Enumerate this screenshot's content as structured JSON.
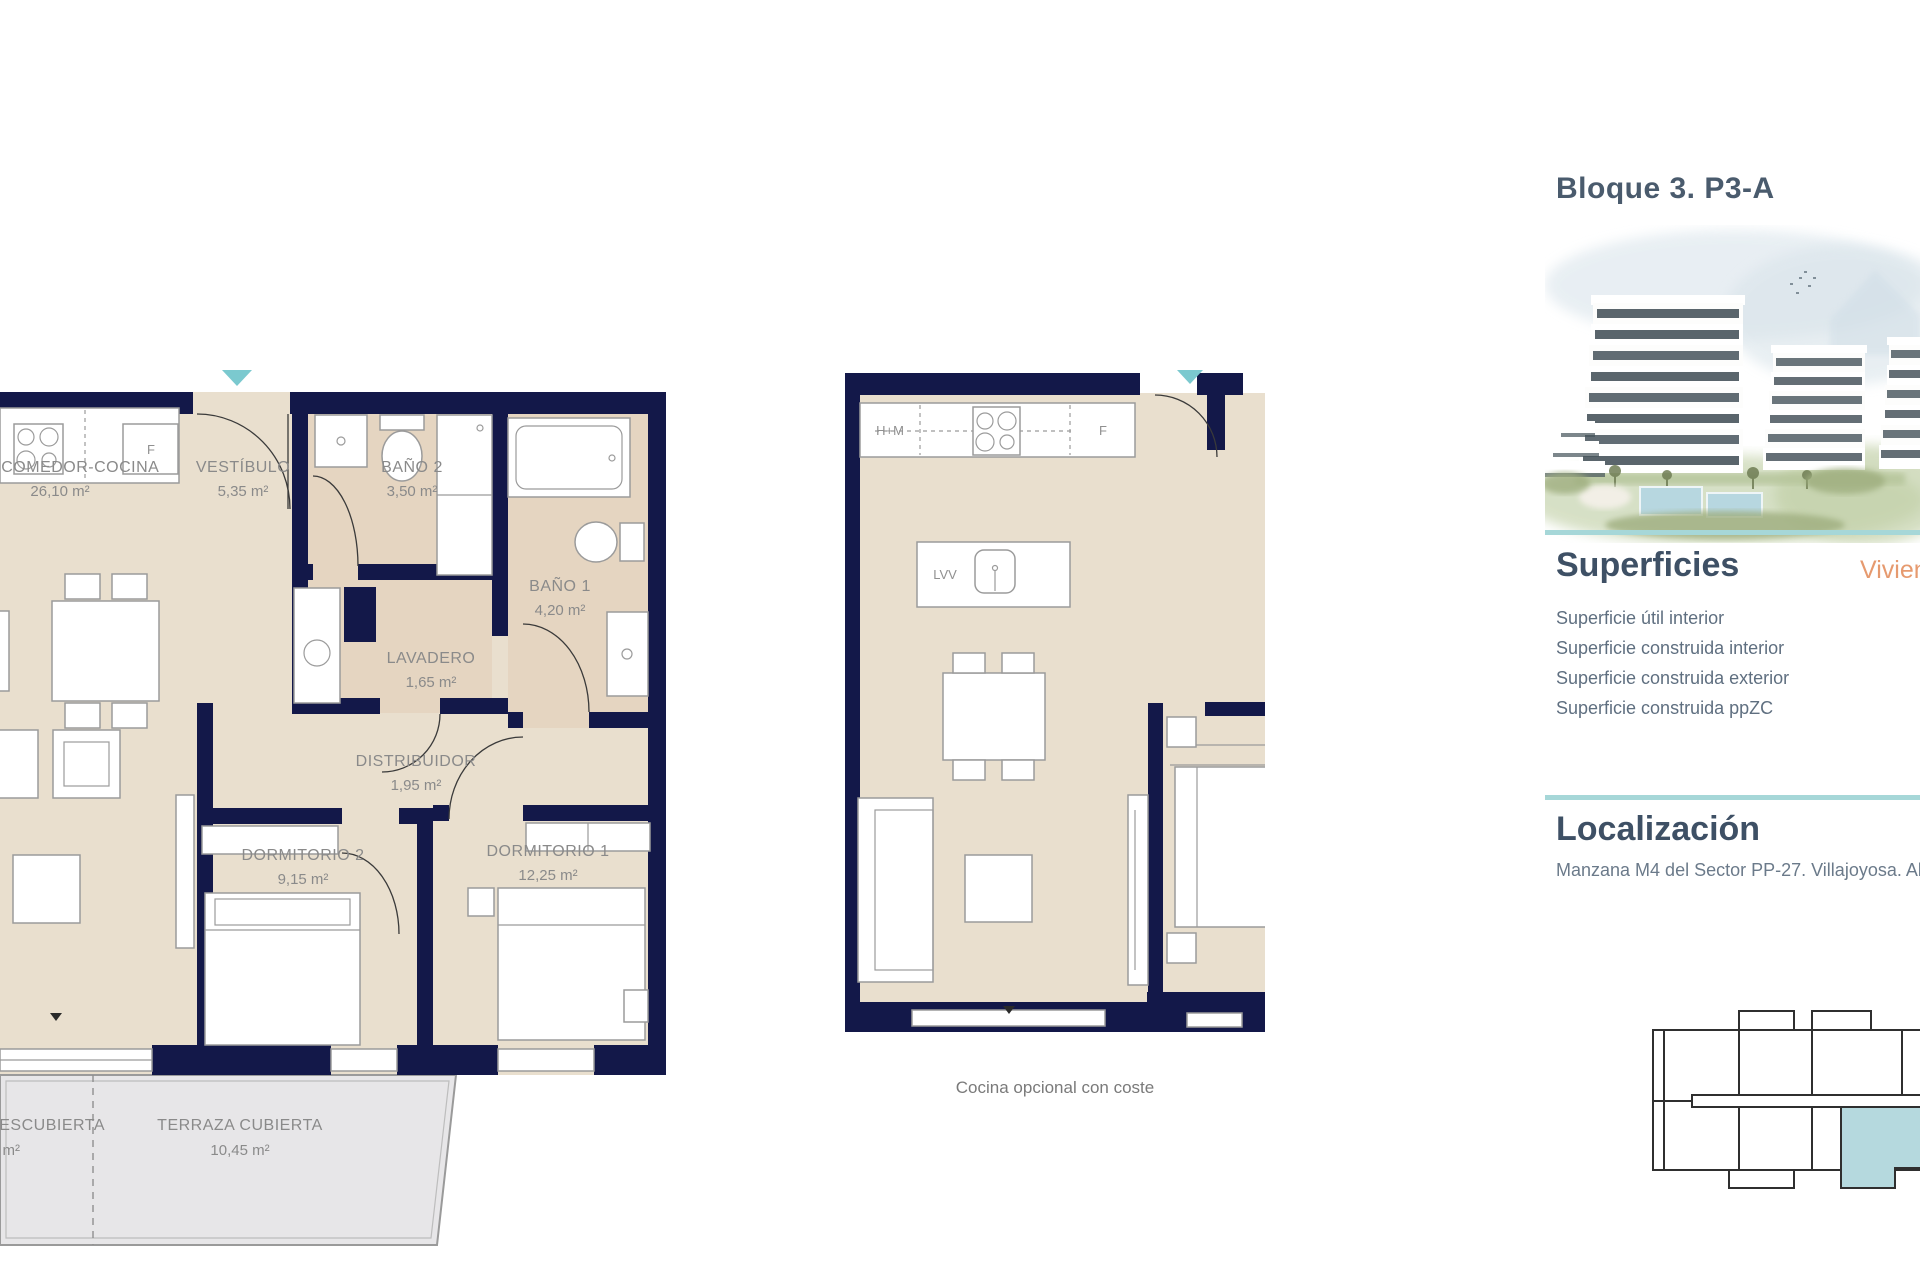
{
  "title": "Bloque 3. P3-A",
  "superficies": {
    "heading": "Superficies",
    "unit_label": "Vivienda",
    "rows": [
      "Superficie útil interior",
      "Superficie construida interior",
      "Superficie construida exterior",
      "Superficie construida ppZC"
    ]
  },
  "localizacion": {
    "heading": "Localización",
    "address": "Manzana M4 del Sector PP-27. Villajoyosa. Alicante"
  },
  "plan_main": {
    "rooms": {
      "salon": {
        "name": "SALÓN-COMEDOR-COCINA",
        "area": "26,10 m²"
      },
      "vestibulo": {
        "name": "VESTÍBULO",
        "area": "5,35 m²"
      },
      "bano2": {
        "name": "BAÑO 2",
        "area": "3,50 m²"
      },
      "bano1": {
        "name": "BAÑO 1",
        "area": "4,20 m²"
      },
      "lavadero": {
        "name": "LAVADERO",
        "area": "1,65 m²"
      },
      "distribuidor": {
        "name": "DISTRIBUIDOR",
        "area": "1,95 m²"
      },
      "dormitorio2": {
        "name": "DORMITORIO 2",
        "area": "9,15 m²"
      },
      "dormitorio1": {
        "name": "DORMITORIO 1",
        "area": "12,25 m²"
      },
      "terraza_cubierta": {
        "name": "TERRAZA CUBIERTA",
        "area": "10,45 m²"
      },
      "terraza_descubierta": {
        "name": "TERRAZA DESCUBIERTA",
        "area": "0 m²"
      }
    },
    "labels": {
      "fridge": "F"
    }
  },
  "plan_optional": {
    "caption": "Cocina opcional con coste",
    "labels": {
      "hm": "H+M",
      "fridge": "F",
      "dishwasher": "LVV"
    }
  },
  "colors": {
    "wall_navy": "#131849",
    "floor_beige": "#e9dfce",
    "bath_tan": "#e5d5c1",
    "terrace_gray": "#e7e6e8",
    "accent_teal": "#a6d7d8",
    "entrance_teal": "#7bc9cf",
    "keyplan_highlight": "#b5d9de",
    "heading_blue": "#3e5065",
    "label_gray": "#8a8a8a",
    "orange": "#e69a6f"
  }
}
